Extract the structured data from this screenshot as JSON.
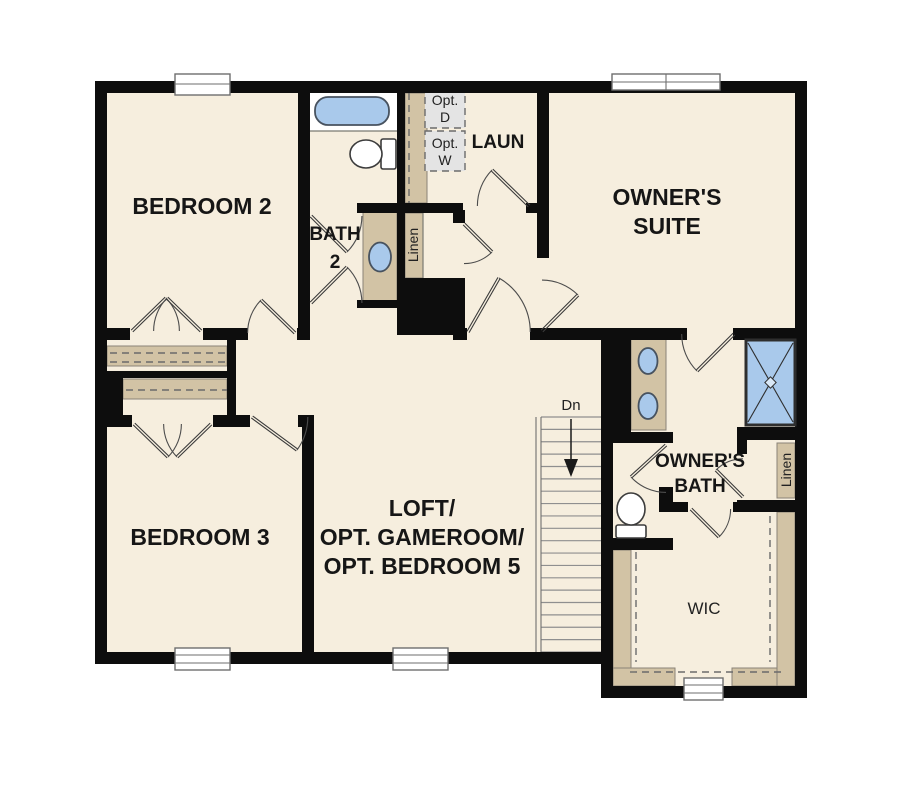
{
  "plan": {
    "rooms": {
      "bedroom2": {
        "label": "BEDROOM 2"
      },
      "bath2": {
        "line1": "BATH",
        "line2": "2"
      },
      "laundry": {
        "label": "LAUN"
      },
      "owners_suite": {
        "line1": "OWNER'S",
        "line2": "SUITE"
      },
      "bedroom3": {
        "label": "BEDROOM 3"
      },
      "loft": {
        "line1": "LOFT/",
        "line2": "OPT. GAMEROOM/",
        "line3": "OPT. BEDROOM 5"
      },
      "owners_bath": {
        "line1": "OWNER'S",
        "line2": "BATH"
      },
      "wic": {
        "label": "WIC"
      }
    },
    "closets": {
      "linen_hall": {
        "label": "Linen"
      },
      "linen_bath": {
        "label": "Linen"
      }
    },
    "laundry_options": {
      "dryer_line1": "Opt.",
      "dryer_line2": "D",
      "washer_line1": "Opt.",
      "washer_line2": "W"
    },
    "stairs": {
      "down_label": "Dn"
    }
  },
  "colors": {
    "wall": "#0d0d0d",
    "floor": "#f6eede",
    "cabinet": "#d2c3a5",
    "fixture_blue": "#a9c9eb",
    "optional_gray": "#e4e4e4"
  }
}
